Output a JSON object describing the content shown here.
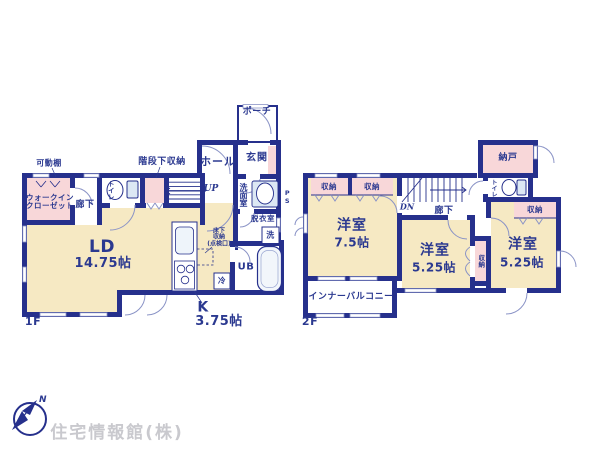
{
  "colors": {
    "wall": "#26308c",
    "text": "#2b3990",
    "room_cream": "#f6e9c3",
    "room_pink": "#f8d7d9",
    "fixture_blue": "#dce8f4",
    "arc_grey": "#8a93c6",
    "watermark_grey": "#c9c9ce"
  },
  "floor1": {
    "floor_label": "1F",
    "movable_shelf": "可動棚",
    "walk_in_closet": {
      "line1": "ウォークイン",
      "line2": "クローゼット"
    },
    "corridor": "廊下",
    "toilet": "トイレ",
    "under_stair_storage": "階段下収納",
    "up": "UP",
    "hall": "ホール",
    "entrance": "玄関",
    "porch": "ポーチ",
    "washroom": "洗面室",
    "pipe_space": "PS",
    "dressing_room": "脱衣室",
    "washer": "洗",
    "unit_bath": "UB",
    "fridge": "冷",
    "underfloor_storage": {
      "line1": "床下",
      "line2": "収納",
      "line3": "(点検口)"
    },
    "living_dining": {
      "name": "LD",
      "size": "14.75帖"
    },
    "kitchen": {
      "name": "K",
      "size": "3.75帖"
    }
  },
  "floor2": {
    "floor_label": "2F",
    "storage_room": "納戸",
    "toilet": "トイレ",
    "closet1": "収納",
    "closet2": "収納",
    "closet3": "収納",
    "closet4": "収納",
    "down": "DN",
    "corridor": "廊下",
    "western_room_1": {
      "name": "洋室",
      "size": "7.5帖"
    },
    "western_room_2": {
      "name": "洋室",
      "size": "5.25帖"
    },
    "western_room_3": {
      "name": "洋室",
      "size": "5.25帖"
    },
    "inner_balcony": "インナーバルコニー"
  },
  "footer": {
    "company": "住宅情報館(株)",
    "compass_north": "N"
  }
}
